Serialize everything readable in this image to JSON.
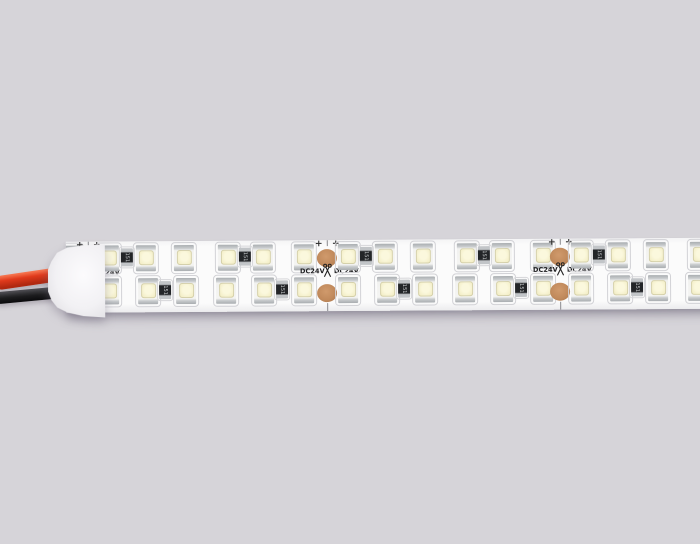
{
  "scene": {
    "description": "Product photo: white flexible LED strip light, double row SMD LEDs, DC24V, with red and black power wires and white silicone end cap",
    "background_color": "#d6d4d9"
  },
  "labels": {
    "voltage": "DC24V",
    "polarity": "+",
    "resistor_code": "151"
  },
  "colors": {
    "pcb_white": "#fbfbfb",
    "led_window": "#fbf8dd",
    "resistor_body": "#232528",
    "resistor_terminal": "#c2c5c8",
    "copper_pad": "#c18a5c",
    "wire_red": "#e03a1c",
    "wire_black": "#1c1c1e",
    "end_cap": "#f2f1f4",
    "print_black": "#1e1e20"
  },
  "strip": {
    "tilt_deg": -0.35,
    "cut_pitch": 233,
    "cut_xs": [
      -145,
      88,
      327,
      560
    ],
    "pcb": {
      "x": 66,
      "y": 240,
      "width": 646,
      "height": 71
    },
    "rows": {
      "top": {
        "led_y": 4,
        "led_offsets": [
          11,
          48,
          86,
          130,
          165,
          206
        ],
        "resistor_y": 7,
        "resistor_offsets": [
          33,
          151
        ]
      },
      "bottom": {
        "led_y": 37,
        "led_offsets": [
          11,
          50,
          88,
          128,
          166,
          206
        ],
        "resistor_y": 40,
        "resistor_offsets": [
          71,
          188
        ]
      }
    },
    "pad": {
      "width": 20,
      "height": 18,
      "top_cy": 18,
      "bottom_cy": 53
    },
    "plus_dx": [
      -13,
      4
    ],
    "label_left_dx": -27,
    "label_right_dx": 7
  }
}
